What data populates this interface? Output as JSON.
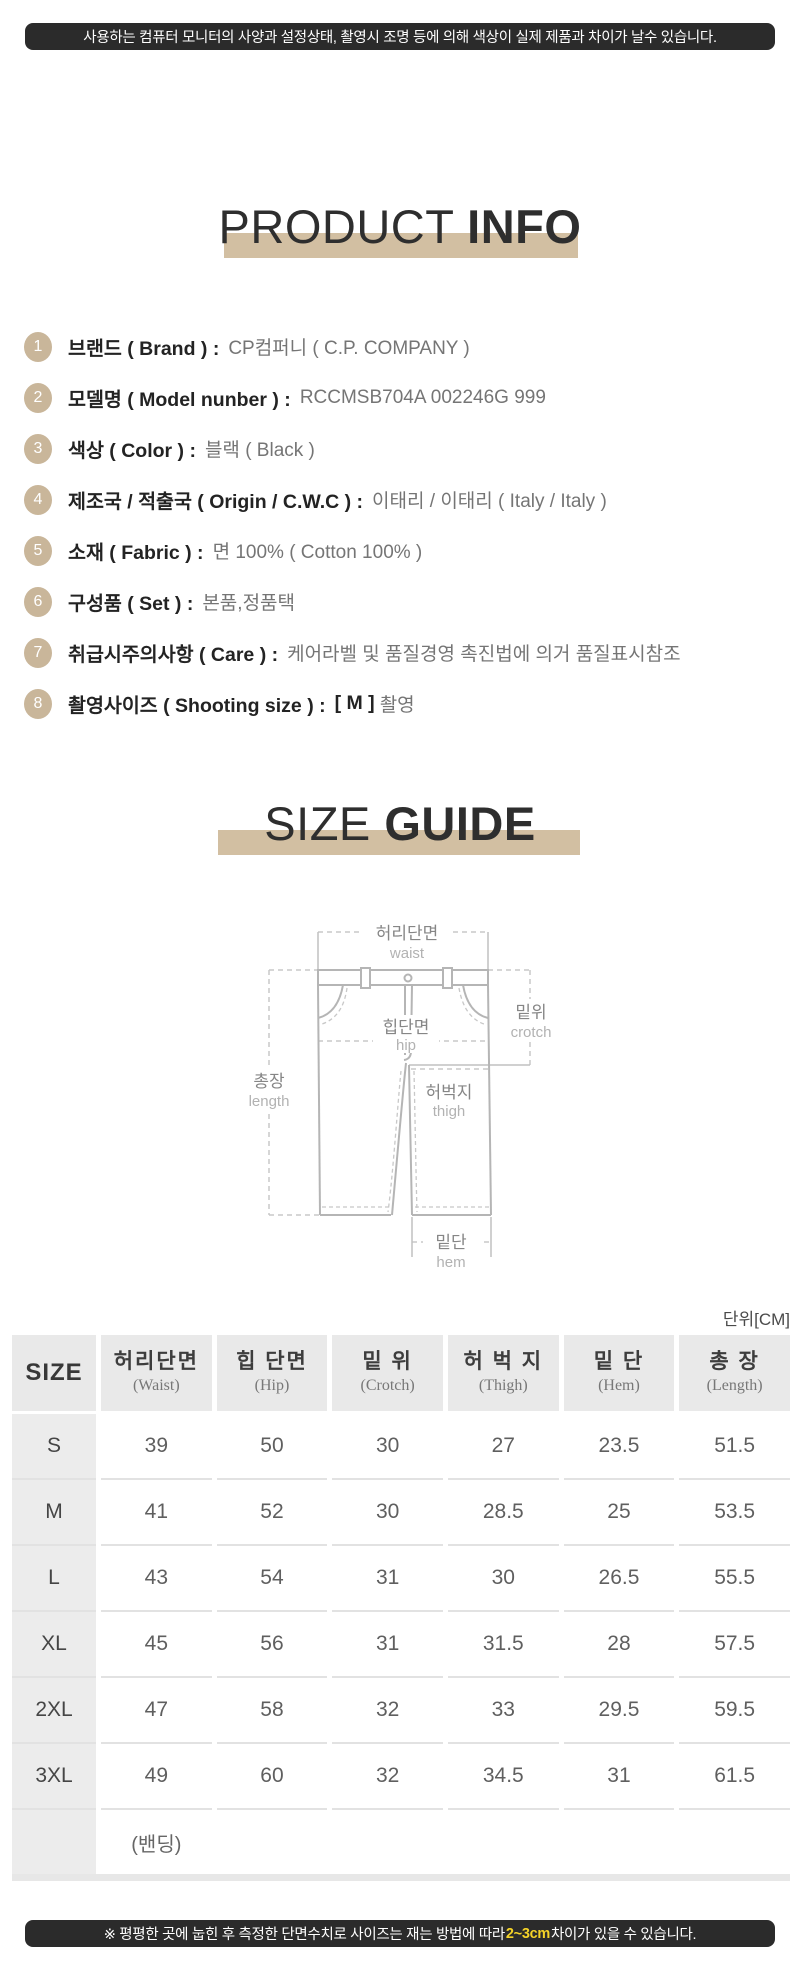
{
  "top_banner": {
    "text": "사용하는 컴퓨터 모니터의 사양과 설정상태, 촬영시 조명 등에 의해 색상이 실제 제품과 차이가 날수 있습니다."
  },
  "product_info": {
    "title_light": "PRODUCT",
    "title_bold": "INFO",
    "items": [
      {
        "num": "1",
        "label": "브랜드 ( Brand ) :",
        "value": "CP컴퍼니 ( C.P. COMPANY )"
      },
      {
        "num": "2",
        "label": "모델명 ( Model nunber ) :",
        "value": "RCCMSB704A 002246G 999"
      },
      {
        "num": "3",
        "label": "색상 ( Color ) :",
        "value": "블랙 ( Black )"
      },
      {
        "num": "4",
        "label": "제조국 / 적출국 ( Origin / C.W.C ) :",
        "value": "이태리 / 이태리 ( Italy / Italy )"
      },
      {
        "num": "5",
        "label": "소재 ( Fabric ) :",
        "value": "면 100%  ( Cotton 100% )"
      },
      {
        "num": "6",
        "label": "구성품 ( Set ) :",
        "value": "본품,정품택"
      },
      {
        "num": "7",
        "label": "취급시주의사항 ( Care ) :",
        "value": "케어라벨 및 품질경영 촉진법에 의거 품질표시참조"
      },
      {
        "num": "8",
        "label": "촬영사이즈 ( Shooting size ) :",
        "value_bold": "[ M ]",
        "value": "촬영"
      }
    ]
  },
  "size_guide": {
    "title_light": "SIZE",
    "title_bold": "GUIDE",
    "diagram": {
      "waist": {
        "ko": "허리단면",
        "en": "waist"
      },
      "crotch": {
        "ko": "밑위",
        "en": "crotch"
      },
      "hip": {
        "ko": "힙단면",
        "en": "hip"
      },
      "length": {
        "ko": "총장",
        "en": "length"
      },
      "thigh": {
        "ko": "허벅지",
        "en": "thigh"
      },
      "hem": {
        "ko": "밑단",
        "en": "hem"
      }
    }
  },
  "size_table": {
    "unit": "단위[CM]",
    "columns": [
      {
        "ko": "SIZE",
        "en": ""
      },
      {
        "ko": "허리단면",
        "en": "(Waist)"
      },
      {
        "ko": "힙 단면",
        "en": "(Hip)"
      },
      {
        "ko": "밑 위",
        "en": "(Crotch)"
      },
      {
        "ko": "허 벅 지",
        "en": "(Thigh)"
      },
      {
        "ko": "밑 단",
        "en": "(Hem)"
      },
      {
        "ko": "총 장",
        "en": "(Length)"
      }
    ],
    "rows": [
      {
        "size": "S",
        "values": [
          "39",
          "50",
          "30",
          "27",
          "23.5",
          "51.5"
        ]
      },
      {
        "size": "M",
        "values": [
          "41",
          "52",
          "30",
          "28.5",
          "25",
          "53.5"
        ]
      },
      {
        "size": "L",
        "values": [
          "43",
          "54",
          "31",
          "30",
          "26.5",
          "55.5"
        ]
      },
      {
        "size": "XL",
        "values": [
          "45",
          "56",
          "31",
          "31.5",
          "28",
          "57.5"
        ]
      },
      {
        "size": "2XL",
        "values": [
          "47",
          "58",
          "32",
          "33",
          "29.5",
          "59.5"
        ]
      },
      {
        "size": "3XL",
        "values": [
          "49",
          "60",
          "32",
          "34.5",
          "31",
          "61.5"
        ]
      }
    ],
    "footer_row": {
      "size": "",
      "values": [
        "(밴딩)",
        "",
        "",
        "",
        "",
        ""
      ]
    }
  },
  "bottom_banner": {
    "prefix": "※ 평평한 곳에 눕힌 후 측정한 단면수치로 사이즈는 재는 방법에 따라 ",
    "highlight": "2~3cm",
    "suffix": "차이가 있을 수 있습니다."
  },
  "colors": {
    "tan_bar": "#d2bfa2",
    "tan_circle": "#c9b69a",
    "banner_bg": "#2b2b2b",
    "highlight_yellow": "#f5d328"
  }
}
